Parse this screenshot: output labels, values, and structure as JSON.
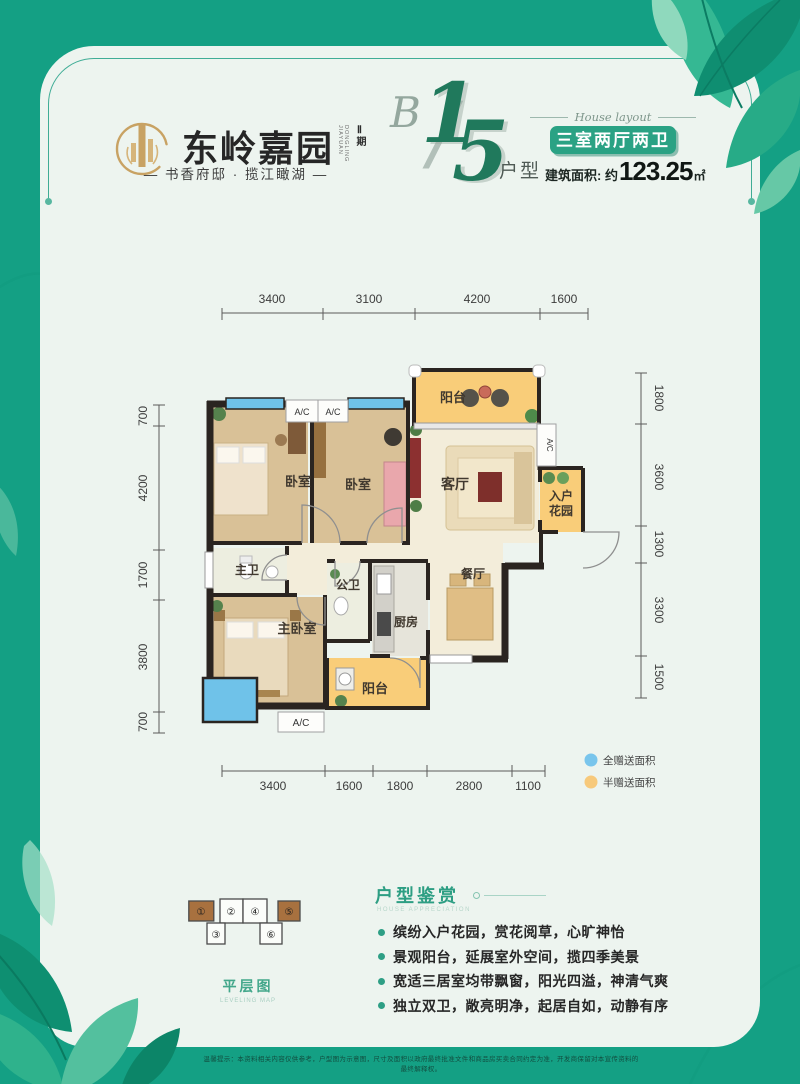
{
  "colors": {
    "background_teal": "#14a084",
    "card_mint": "#edf4ef",
    "badge_green": "#2aa284",
    "figure_green": "#20795c",
    "gold": "#c8a263",
    "full_gift_blue": "#79c5ec",
    "half_gift_yellow": "#f7c97b",
    "balcony_yellow": "#f9cd79",
    "wood_floor": "#d9c197"
  },
  "header": {
    "brand": "东岭嘉园",
    "brand_en": "DONGLING JIAYUAN",
    "phase": "Ⅱ期",
    "tagline": "— 书香府邸 · 揽江瞰湖 —",
    "unit_letter": "B",
    "unit_digit1": "1",
    "unit_slash": "/",
    "unit_digit2": "5",
    "unit_suffix": "户型",
    "layout_script": "House layout",
    "badge": "三室两厅两卫",
    "area_prefix": "建筑面积: 约",
    "area_value": "123.25",
    "area_unit": "㎡"
  },
  "plan": {
    "dims_top": [
      "3400",
      "3100",
      "4200",
      "1600"
    ],
    "dims_left": [
      "700",
      "4200",
      "1700",
      "3800",
      "700"
    ],
    "dims_right": [
      "1800",
      "3600",
      "1300",
      "3300",
      "1500"
    ],
    "dims_bottom": [
      "3400",
      "1600",
      "1800",
      "2800",
      "1100"
    ],
    "rooms": {
      "balcony_top": "阳台",
      "bedroom_a": "卧室",
      "bedroom_b": "卧室",
      "living": "客厅",
      "garden_line1": "入户",
      "garden_line2": "花园",
      "dining": "餐厅",
      "master_bath": "主卫",
      "public_bath": "公卫",
      "kitchen": "厨房",
      "master_bedroom": "主卧室",
      "balcony_bottom": "阳台"
    },
    "ac_label": "A/C",
    "legend": [
      {
        "color": "#79c5ec",
        "label": "全赠送面积"
      },
      {
        "color": "#f7c97b",
        "label": "半赠送面积"
      }
    ]
  },
  "level_map": {
    "title": "平层图",
    "subtitle": "LEVELING MAP",
    "units": [
      "①",
      "②",
      "③",
      "④",
      "⑤",
      "⑥"
    ]
  },
  "appreciation": {
    "title": "户型鉴赏",
    "subtitle": "HOUSE APPRECIATION",
    "bullets": [
      "缤纷入户花园，赏花阅草，心旷神怡",
      "景观阳台，延展室外空间，揽四季美景",
      "宽适三居室均带飘窗，阳光四溢，神清气爽",
      "独立双卫，敞亮明净，起居自如，动静有序"
    ]
  },
  "footer": {
    "disclaimer": "温馨提示：本资料相关内容仅供参考，户型图为示意图，尺寸及面积以政府最终批准文件和商品房买卖合同约定为准，开发商保留对本宣传资料的最终解释权。"
  }
}
